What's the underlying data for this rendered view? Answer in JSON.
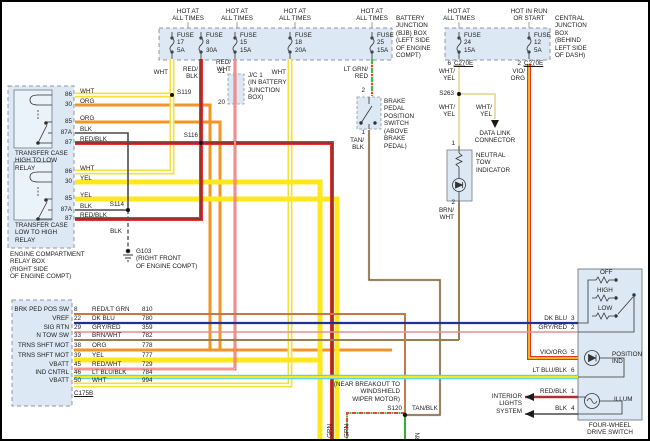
{
  "palette": {
    "box_fill": "#dce9f5",
    "box_border": "#8b97a3",
    "text": "#1b1b1b",
    "yel": "#ffe71c",
    "org": "#f49426",
    "red": "#e8312a",
    "wht_edge": "#f3df3d",
    "dk_blu": "#20338f",
    "gry_red": "#e09194",
    "brn_wht": "#9b7d52",
    "tan_blk": "#b49d71",
    "wht_yel": "#e8deA0",
    "lt_grn": "#43bb43",
    "grn": "#2fb52f",
    "lt_blu": "#58d8d8",
    "blk": "#4a4a4a"
  },
  "top": {
    "hot1": "HOT AT\nALL TIMES",
    "hot2": "HOT AT\nALL TIMES",
    "hot3": "HOT AT\nALL TIMES",
    "hot4": "HOT AT\nALL TIMES",
    "hot5": "HOT AT\nALL TIMES",
    "hot6": "HOT IN RUN\nOR START",
    "bjb_label": "BATTERY\nJUNCTION\n(BJB) BOX\n(LEFT SIDE\nOF ENGINE\nCOMPT)",
    "cjb_label": "CENTRAL\nJUNCTION\nBOX\n(BEHIND\nLEFT SIDE\nOF DASH)",
    "f17": "FUSE\n17\n5A",
    "f8": "FUSE\n8\n30A",
    "f15": "FUSE\n15\n15A",
    "f18": "FUSE\n18\n20A",
    "f25": "FUSE\n25\n15A",
    "f24": "FUSE\n24\n15A",
    "f12": "FUSE\n12\n5A",
    "c270e_pin6": "6",
    "c270e_1": "C270E",
    "c270e_pin2": "2",
    "c270e_2": "C270E",
    "w_wht17": "WHT",
    "w_redblk": "RED/\nBLK",
    "w_redwht": "RED/\nWHT",
    "jc1_pin21": "21",
    "jc1_pin20": "20",
    "jc1": "J/C 1\n(IN BATTERY\nJUNCTION\nBOX)",
    "w_wht18": "WHT",
    "w_ltgrnred": "LT GRN/\nRED",
    "w_whtyel1": "WHT/\nYEL",
    "w_vioorg": "VIO/\nORG"
  },
  "mid": {
    "s263": "S263",
    "w_whtyel2": "WHT/\nYEL",
    "w_whtyel3": "WHT/\nYEL",
    "dlc": "DATA LINK\nCONNECTOR",
    "bpp_pin2": "2",
    "bpp_pin1": "1",
    "bpp": "BRAKE\nPEDAL\nPOSITION\nSWITCH\n(ABOVE\nBRAKE\nPEDAL)",
    "w_tanblk": "TAN/\nBLK",
    "nti_pin1": "1",
    "nti_pin2": "2",
    "nti": "NEUTRAL\nTOW\nINDICATOR",
    "w_brnwht": "BRN/\nWHT",
    "s120_note": "(NEAR BREAKOUT TO\nWINDSHIELD\nWIPER MOTOR)",
    "s120": "S120",
    "tanblk2": "TAN/BLK",
    "ltgrn_rot1": "LT GRN",
    "ltgrn_rot2": "LT GRN",
    "grn_rot": "GRN"
  },
  "relays": {
    "s119": "S119",
    "s116": "S116",
    "s114": "S114",
    "relay1_label": "TRANSFER CASE\nHIGH TO LOW\nRELAY",
    "relay2_label": "TRANSFER CASE\nLOW TO HIGH\nRELAY",
    "box_label": "ENGINE COMPARTMENT\nRELAY BOX\n(RIGHT SIDE\nOF ENGINE COMPT)",
    "r1_pins": [
      "86",
      "30",
      "85",
      "87A",
      "87"
    ],
    "r1_wires": [
      "WHT",
      "ORG",
      "ORG",
      "BLK",
      "RED/BLK"
    ],
    "r2_pins": [
      "86",
      "30",
      "85",
      "87A",
      "87"
    ],
    "r2_wires": [
      "WHT",
      "YEL",
      "YEL",
      "BLK",
      "RED/BLK"
    ],
    "blk_gnd": "BLK",
    "g103": "G103\n(RIGHT FRONT\nOF ENGINE COMPT)"
  },
  "pcm": {
    "rows": [
      {
        "label": "BRK PED POS SW",
        "pin": "8",
        "color": "RED/LT GRN",
        "circuit": "810"
      },
      {
        "label": "VREF",
        "pin": "22",
        "color": "DK BLU",
        "circuit": "780"
      },
      {
        "label": "SIG RTN",
        "pin": "29",
        "color": "GRY/RED",
        "circuit": "359"
      },
      {
        "label": "N TOW SW",
        "pin": "33",
        "color": "BRN/WHT",
        "circuit": "782"
      },
      {
        "label": "TRNS SHFT MOT",
        "pin": "38",
        "color": "ORG",
        "circuit": "778"
      },
      {
        "label": "TRNS SHFT MOT",
        "pin": "39",
        "color": "YEL",
        "circuit": "777"
      },
      {
        "label": "VBATT",
        "pin": "45",
        "color": "RED/WHT",
        "circuit": "729"
      },
      {
        "label": "IND CNTRL",
        "pin": "46",
        "color": "LT BLU/BLK",
        "circuit": "784"
      },
      {
        "label": "VBATT",
        "pin": "50",
        "color": "WHT",
        "circuit": "994"
      }
    ],
    "connector": "C175B"
  },
  "fwd_switch": {
    "off": "OFF",
    "high": "HIGH",
    "low": "LOW",
    "pin3_wire": "DK BLU",
    "pin3": "3",
    "pin2_wire": "GRY/RED",
    "pin2": "2",
    "pin5_wire": "VIO/ORG",
    "pin5": "5",
    "pin6_wire": "LT BLU/BLK",
    "pin6": "6",
    "pin1_wire": "RED/BLK",
    "pin1": "1",
    "pin4_wire": "BLK",
    "pin4": "4",
    "position_ind": "POSITION\nIND",
    "illum": "ILLUM",
    "interior": "INTERIOR\nLIGHTS\nSYSTEM",
    "label": "FOUR-WHEEL\nDRIVE SWITCH"
  }
}
